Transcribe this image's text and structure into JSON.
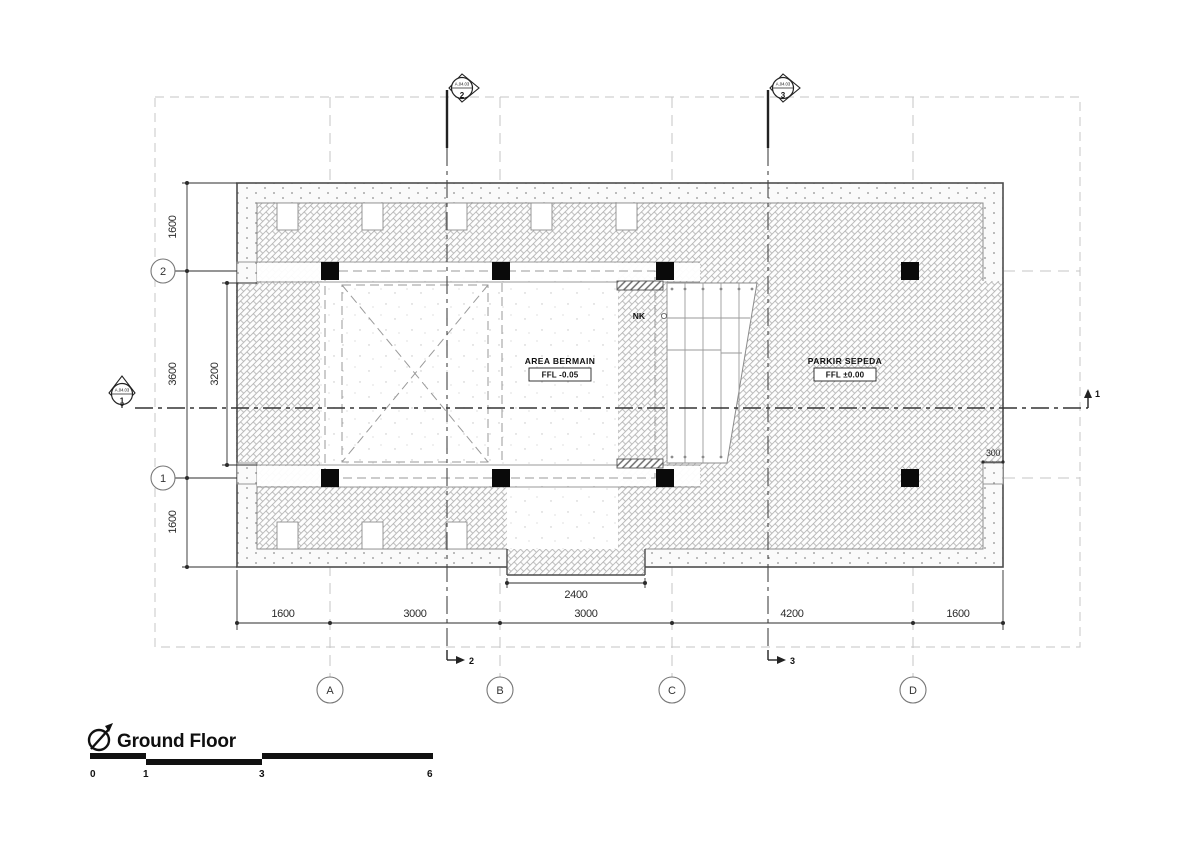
{
  "title": {
    "label": "Ground Floor"
  },
  "scale_bar": {
    "labels": [
      "0",
      "1",
      "3",
      "6"
    ]
  },
  "grid": {
    "columns": [
      {
        "label": "A"
      },
      {
        "label": "B"
      },
      {
        "label": "C"
      },
      {
        "label": "D"
      }
    ],
    "rows": [
      {
        "label": "2"
      },
      {
        "label": "1"
      }
    ]
  },
  "section_markers": {
    "sheet_ref": "A.04.03",
    "top": [
      {
        "number": "2"
      },
      {
        "number": "3"
      }
    ],
    "left": {
      "number": "1"
    },
    "tails": {
      "bottom": [
        "2",
        "3"
      ],
      "right": "1"
    }
  },
  "dimensions": {
    "bottom": [
      "1600",
      "3000",
      "3000",
      "4200",
      "1600"
    ],
    "left": [
      "1600",
      "3600",
      "1600"
    ],
    "left_inner": "3200",
    "bottom_inner": "2400",
    "right_wall": "300"
  },
  "areas": {
    "area_bermain": {
      "label": "AREA BERMAIN",
      "level": "FFL  -0.05"
    },
    "parkir_sepeda": {
      "label": "PARKIR SEPEDA",
      "level": "FFL  ±0.00"
    },
    "rack_label": "NK"
  },
  "colors": {
    "line_dark": "#4d4d4d",
    "line_thin": "#8c8c8c",
    "hatch": "#adadad",
    "dim": "#2b2b2b",
    "grid_dash": "#c6c6c6"
  }
}
